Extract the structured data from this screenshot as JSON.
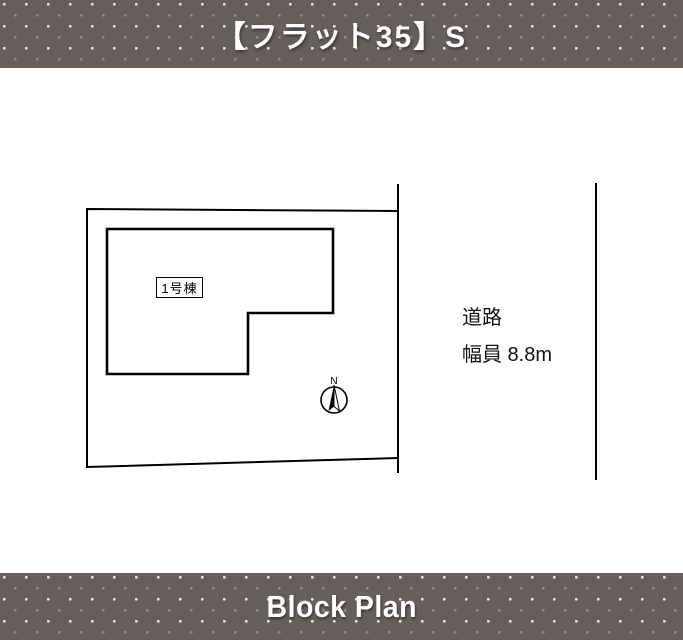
{
  "header": {
    "title": "【フラット35】S"
  },
  "footer": {
    "title": "Block Plan"
  },
  "plan": {
    "building_label": "1号棟",
    "road": {
      "label": "道路",
      "width_label": "幅員 8.8m"
    },
    "compass": {
      "north_label": "N"
    }
  },
  "colors": {
    "band_background": "#675F5C",
    "dot_bright": "#EFECE9",
    "dot_dim": "#938C88",
    "line_color": "#000000",
    "canvas_background": "#FFFFFF"
  }
}
